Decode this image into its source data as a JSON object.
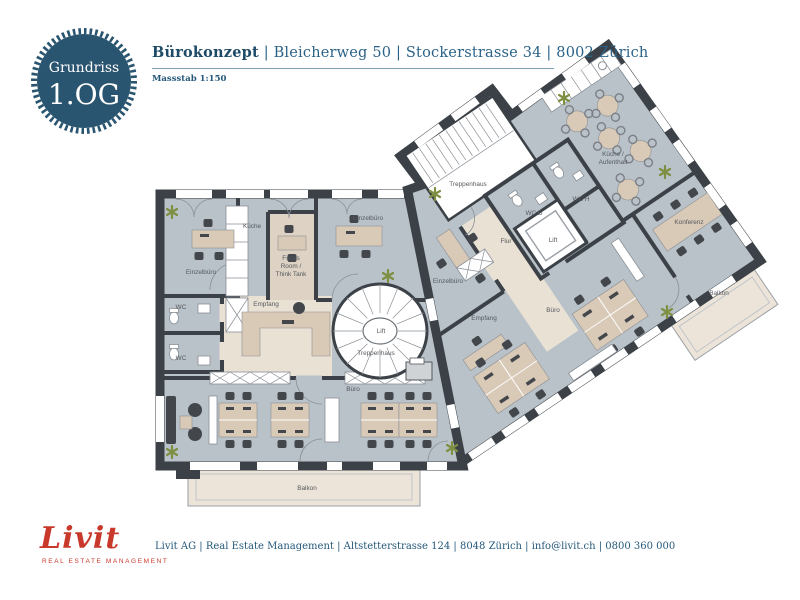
{
  "badge": {
    "title": "Grundriss",
    "floor": "1.OG",
    "bg_color": "#2a5570",
    "text_color": "#ffffff"
  },
  "header": {
    "project": "Bürokonzept",
    "address": "| Bleicherweg 50 | Stockerstrasse 34 | 8002 Zürich",
    "scale": "Massstab 1:150",
    "text_color": "#24587a"
  },
  "plan": {
    "colors": {
      "wall": "#3b4147",
      "floor": "#b9c2c9",
      "reception_floor": "#e9e1d4",
      "focus_floor": "#ddd2c4",
      "balcony": "#ece4d8",
      "desk": "#d9c9b7",
      "chair": "#43474c",
      "plant": "#7e8f41",
      "label": "#55595e"
    },
    "labels": {
      "einzelbuero_left": "Einzelbüro",
      "kueche_left": "Küche",
      "focus_1": "Focus",
      "focus_2": "Room /",
      "focus_3": "Think Tank",
      "einzelbuero_left2": "Einzelbüro",
      "wc_top": "WC",
      "wc_bottom": "WC",
      "empfang_left": "Empfang",
      "lift_left": "Lift",
      "treppenhaus_left": "Treppenhaus",
      "buero_left": "Büro",
      "balkon_left": "Balkon",
      "treppenhaus_right": "Treppenhaus",
      "wc_d": "WC D",
      "wc_h": "WC H",
      "flur": "Flur",
      "lift_right": "Lift",
      "kueche_right_1": "Küche /",
      "kueche_right_2": "Aufenthalt",
      "einzelbuero_right": "Einzelbüro",
      "empfang_right": "Empfang",
      "buero_right": "Büro",
      "konferenz": "Konferenz",
      "balkon_right": "Balkon"
    }
  },
  "footer": {
    "logo": "Livit",
    "tagline": "Real Estate Management",
    "contact": "Livit AG | Real Estate Management | Altstetterstrasse 124 | 8048 Zürich | info@livit.ch | 0800 360 000",
    "logo_color": "#c9392b"
  }
}
